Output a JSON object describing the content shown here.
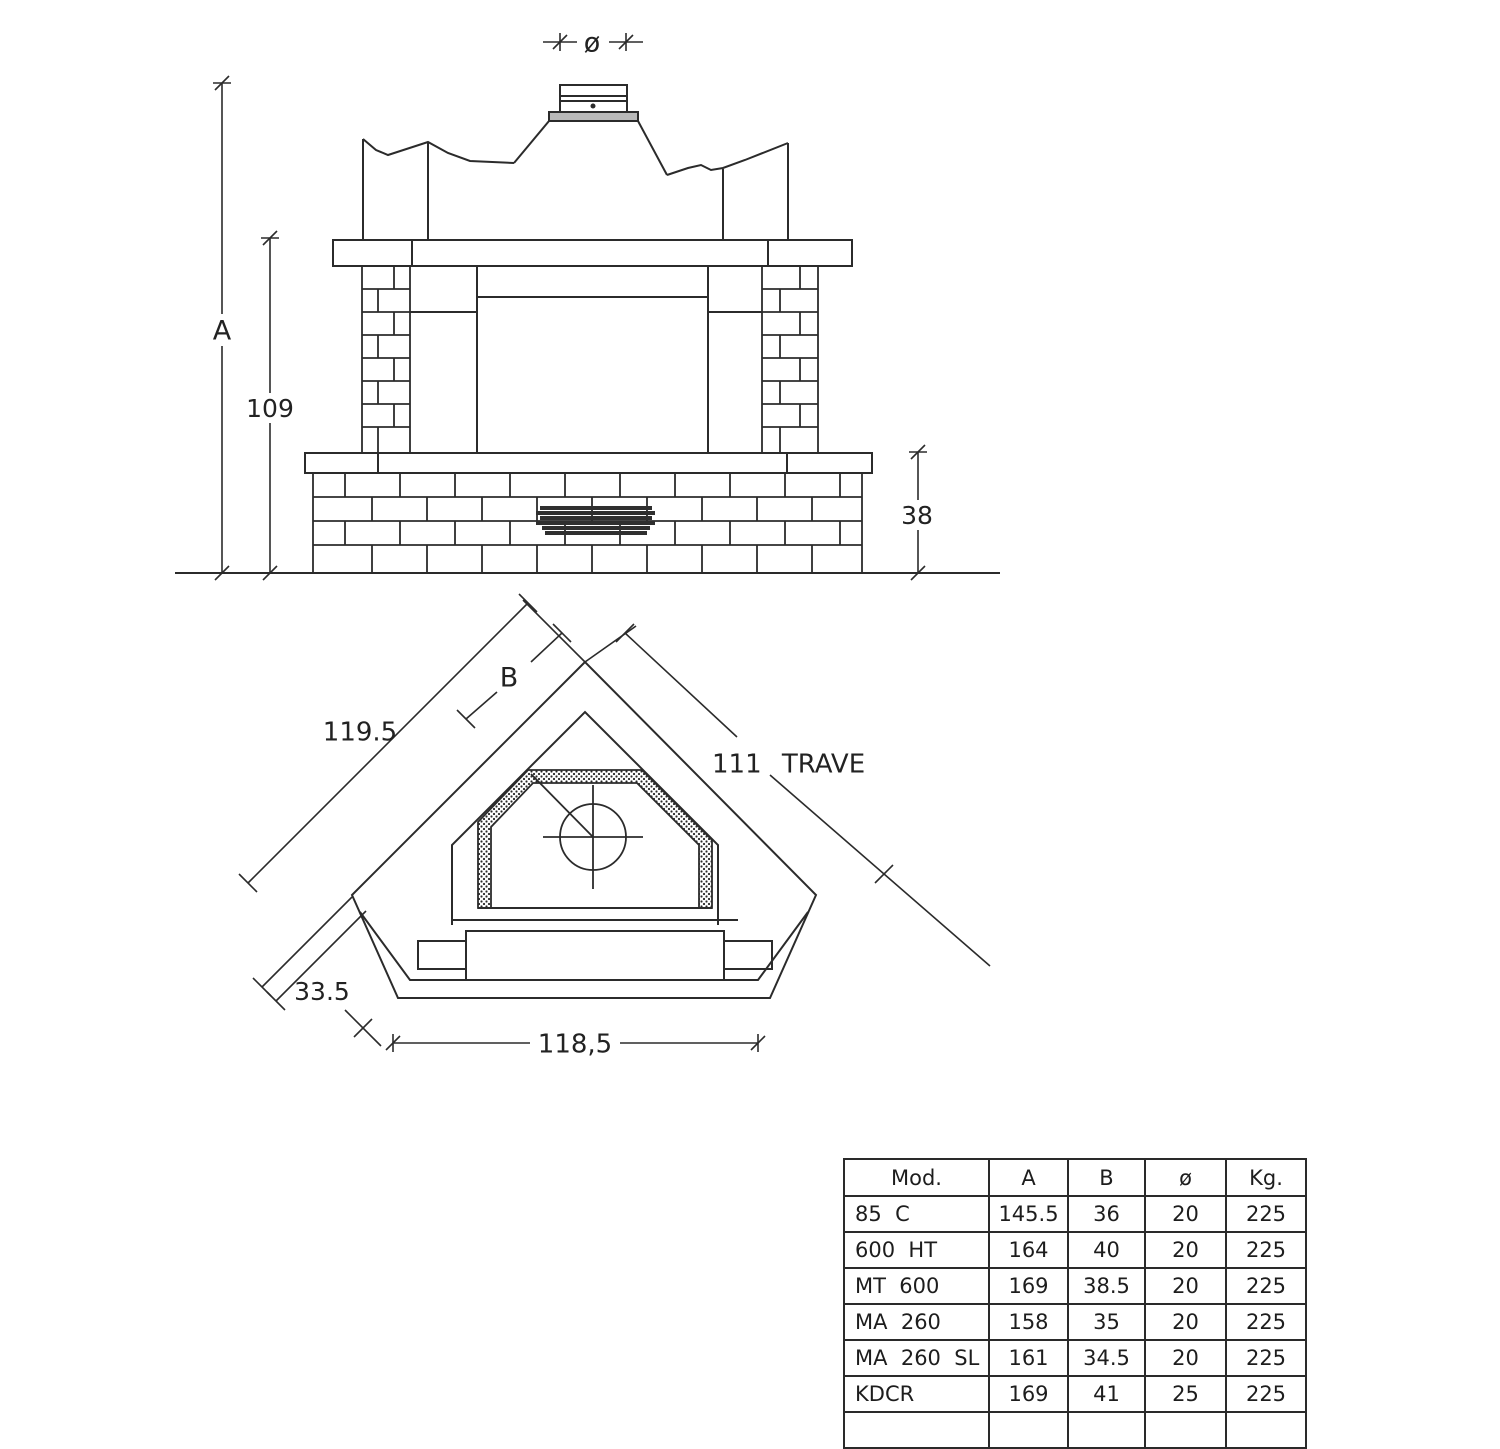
{
  "style": {
    "line_color": "#2b2b2b",
    "collar_fill": "#b9b9b9",
    "grate_fill": "#2f2f2f"
  },
  "front_view": {
    "dim_flue": "ø",
    "dim_total_height": "A",
    "dim_mantel_height": "109",
    "dim_base_height": "38"
  },
  "plan_view": {
    "dim_back_left": "119.5",
    "dim_hood": "B",
    "dim_beam": "111 TRAVE",
    "dim_side": "33.5",
    "dim_front": "118,5"
  },
  "table": {
    "headers": [
      "Mod.",
      "A",
      "B",
      "ø",
      "Kg."
    ],
    "rows": [
      {
        "model": "85  C",
        "a": "145.5",
        "b": "36",
        "d": "20",
        "kg": "225"
      },
      {
        "model": "600  HT",
        "a": "164",
        "b": "40",
        "d": "20",
        "kg": "225"
      },
      {
        "model": "MT  600",
        "a": "169",
        "b": "38.5",
        "d": "20",
        "kg": "225"
      },
      {
        "model": "MA  260",
        "a": "158",
        "b": "35",
        "d": "20",
        "kg": "225"
      },
      {
        "model": "MA  260  SL",
        "a": "161",
        "b": "34.5",
        "d": "20",
        "kg": "225"
      },
      {
        "model": "KDCR",
        "a": "169",
        "b": "41",
        "d": "25",
        "kg": "225"
      }
    ]
  }
}
